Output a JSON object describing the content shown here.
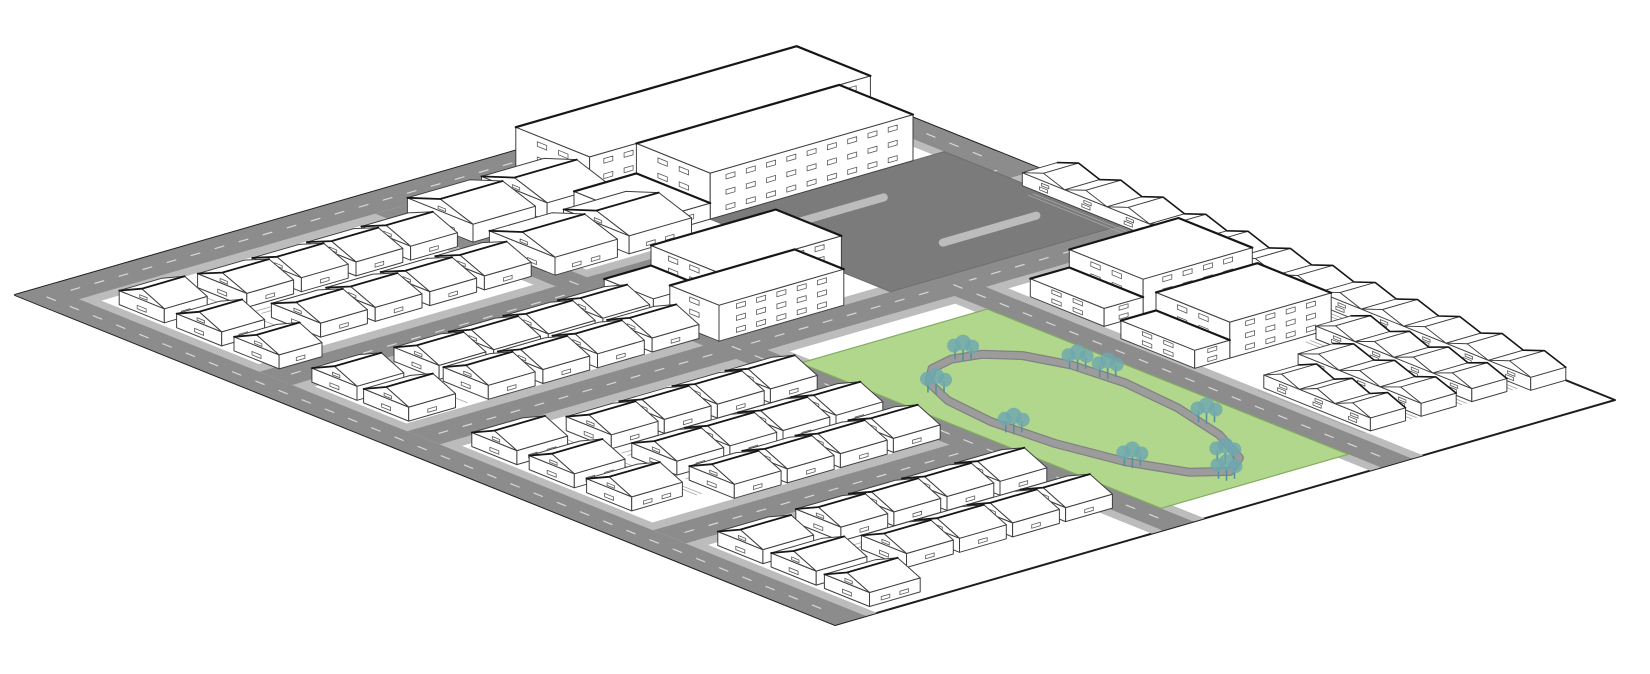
{
  "meta": {
    "alt_text": "Axonometric masterplan diagram of a neighbourhood block: white line-drawn houses, terraces and apartment slabs, a civic complex with a paved plaza, a street grid with sidewalks, and a green park with a loop path and trees."
  },
  "canvas": {
    "w": 1650,
    "h": 674,
    "bg": "#ffffff"
  },
  "projection": {
    "ox": 15,
    "oy": 295,
    "u": [
      8.2,
      3.3
    ],
    "v": [
      7.8,
      -2.25
    ]
  },
  "colors": {
    "outline": "#1d1d1d",
    "ground": "#ffffff",
    "road": "#8c8c8c",
    "roadCasing": "#bcbcbc",
    "roadDash": "#d8d8d8",
    "plaza": "#7b7b7b",
    "park": "#b0d78c",
    "parkEdge": "#84ac60",
    "path": "#9c9c9c",
    "pathEdge": "#828282",
    "tree": "#6fa7b0",
    "treeDark": "#55919c",
    "building": "#ffffff",
    "buildingLine": "#3f3f3f",
    "window": "#5a5a5a",
    "fence": "#a6a6a6",
    "shadow": "#161616"
  },
  "site": {
    "a": [
      0,
      100
    ],
    "b": [
      0,
      100
    ]
  },
  "roads": [
    {
      "name": "road-nw-boundary",
      "a": [
        0,
        4
      ],
      "b": [
        0,
        100
      ],
      "dash": {
        "axis": "b",
        "c": 2,
        "r": [
          2,
          98
        ]
      }
    },
    {
      "name": "road-sw-boundary",
      "a": [
        0,
        100
      ],
      "b": [
        0,
        4
      ],
      "dash": {
        "axis": "a",
        "c": 2,
        "r": [
          2,
          98
        ]
      }
    },
    {
      "name": "road-ne-boundary",
      "a": [
        0,
        30
      ],
      "b": [
        96,
        100
      ],
      "dash": {
        "axis": "a",
        "c": 98,
        "r": [
          1,
          29
        ]
      }
    },
    {
      "name": "street-west",
      "a": [
        26,
        30
      ],
      "b": [
        4,
        100
      ],
      "dash": {
        "axis": "b",
        "c": 28,
        "r": [
          6,
          98
        ]
      }
    },
    {
      "name": "street-central",
      "a": [
        44,
        48
      ],
      "b": [
        4,
        100
      ],
      "dash": {
        "axis": "b",
        "c": 46,
        "r": [
          6,
          98
        ]
      }
    },
    {
      "name": "street-south",
      "a": [
        74,
        78
      ],
      "b": [
        4,
        44
      ],
      "dash": {
        "axis": "b",
        "c": 76,
        "r": [
          6,
          42
        ]
      }
    },
    {
      "name": "avenue-lower",
      "a": [
        4,
        100
      ],
      "b": [
        42,
        46
      ],
      "dash": {
        "axis": "a",
        "c": 44,
        "r": [
          6,
          98
        ]
      }
    },
    {
      "name": "avenue-park",
      "a": [
        44,
        100
      ],
      "b": [
        70,
        74
      ],
      "dash": {
        "axis": "a",
        "c": 72,
        "r": [
          46,
          98
        ]
      }
    }
  ],
  "sidewalks": [
    {
      "a": [
        4,
        5.4
      ],
      "b": [
        0,
        100
      ]
    },
    {
      "a": [
        0,
        100
      ],
      "b": [
        4,
        5.4
      ]
    },
    {
      "a": [
        0,
        30
      ],
      "b": [
        94.6,
        96
      ]
    },
    {
      "a": [
        24.6,
        26
      ],
      "b": [
        4,
        100
      ]
    },
    {
      "a": [
        30,
        31.4
      ],
      "b": [
        4,
        100
      ]
    },
    {
      "a": [
        42.6,
        44
      ],
      "b": [
        4,
        100
      ]
    },
    {
      "a": [
        48,
        49.4
      ],
      "b": [
        4,
        100
      ]
    },
    {
      "a": [
        72.6,
        74
      ],
      "b": [
        4,
        44
      ]
    },
    {
      "a": [
        78,
        79.4
      ],
      "b": [
        4,
        44
      ]
    },
    {
      "a": [
        4,
        100
      ],
      "b": [
        40.6,
        42
      ]
    },
    {
      "a": [
        4,
        100
      ],
      "b": [
        46,
        47.4
      ]
    },
    {
      "a": [
        44,
        100
      ],
      "b": [
        68.6,
        70
      ]
    },
    {
      "a": [
        44,
        100
      ],
      "b": [
        74,
        75.4
      ]
    }
  ],
  "plaza": {
    "a": [
      22,
      44
    ],
    "b": [
      66,
      96
    ],
    "islands": [
      {
        "a": 27,
        "b": [
          71,
          83
        ]
      },
      {
        "a": 38,
        "b": [
          79,
          91
        ]
      }
    ]
  },
  "park": {
    "a": [
      52,
      96
    ],
    "b": [
      46,
      70
    ],
    "loop": [
      [
        93,
        58
      ],
      [
        91.1,
        61.2
      ],
      [
        86,
        64
      ],
      [
        79.1,
        65.9
      ],
      [
        72,
        66.6
      ],
      [
        66.1,
        65.9
      ],
      [
        62,
        64
      ],
      [
        59.7,
        61.2
      ],
      [
        59,
        58
      ],
      [
        59.7,
        54.8
      ],
      [
        62,
        52
      ],
      [
        66.1,
        50.1
      ],
      [
        72,
        49.4
      ],
      [
        79.1,
        50.1
      ],
      [
        86,
        52
      ],
      [
        91.1,
        54.8
      ]
    ],
    "trees": [
      [
        91,
        59.5
      ],
      [
        83,
        65.5
      ],
      [
        70,
        66.5
      ],
      [
        59.5,
        59
      ],
      [
        64,
        50.8
      ],
      [
        75,
        49.2
      ],
      [
        87,
        51.8
      ],
      [
        94,
        56.5
      ],
      [
        67,
        65.8
      ]
    ]
  },
  "fences": [
    {
      "a": [
        15.1,
        15.1
      ],
      "b": [
        15,
        41
      ]
    },
    {
      "a": [
        15.8,
        15.8
      ],
      "b": [
        15,
        41
      ]
    },
    {
      "a": [
        14.9,
        14.9
      ],
      "b": [
        44,
        62
      ]
    },
    {
      "a": [
        38.4,
        38.4
      ],
      "b": [
        16,
        40
      ]
    },
    {
      "a": [
        58.8,
        58.8
      ],
      "b": [
        16,
        42
      ]
    },
    {
      "a": [
        59.5,
        59.5
      ],
      "b": [
        16,
        42
      ]
    },
    {
      "a": [
        66.6,
        66.6
      ],
      "b": [
        16,
        42
      ]
    },
    {
      "a": [
        86.8,
        86.8
      ],
      "b": [
        16,
        42
      ]
    },
    {
      "a": [
        87.5,
        87.5
      ],
      "b": [
        16,
        42
      ]
    },
    {
      "a": [
        50,
        70
      ],
      "b": [
        13.8,
        13.8
      ]
    },
    {
      "a": [
        50,
        70
      ],
      "b": [
        14.4,
        14.4
      ]
    },
    {
      "a": [
        80,
        96
      ],
      "b": [
        13.8,
        13.8
      ]
    },
    {
      "a": [
        6,
        23
      ],
      "b": [
        13.8,
        13.8
      ]
    },
    {
      "a": [
        30,
        42
      ],
      "b": [
        13.8,
        13.8
      ]
    },
    {
      "a": [
        34,
        93
      ],
      "b": [
        94.2,
        94.2
      ]
    },
    {
      "a": [
        34,
        93
      ],
      "b": [
        94.8,
        94.8
      ]
    },
    {
      "a": [
        74,
        93
      ],
      "b": [
        87.7,
        87.7
      ]
    },
    {
      "a": [
        74,
        93
      ],
      "b": [
        88.3,
        88.3
      ]
    },
    {
      "a": [
        78,
        93
      ],
      "b": [
        81.3,
        81.3
      ]
    },
    {
      "a": [
        78,
        93
      ],
      "b": [
        81.9,
        81.9
      ]
    },
    {
      "a": [
        80,
        93
      ],
      "b": [
        75.2,
        75.2
      ]
    }
  ],
  "buildings": [
    {
      "name": "civic-block-rear",
      "type": "slab",
      "a": 4,
      "b": 60,
      "da": 9,
      "db": 36,
      "h": 46,
      "floors": 3
    },
    {
      "name": "civic-block-front",
      "type": "slab",
      "a": 13,
      "b": 66,
      "da": 9,
      "db": 26,
      "h": 46,
      "floors": 3
    },
    {
      "name": "civic-block-wing",
      "type": "slab",
      "a": 13,
      "b": 58,
      "da": 9,
      "db": 8,
      "h": 16,
      "floors": 1
    },
    {
      "name": "apartment-ne-1-low",
      "type": "slab",
      "a": 52,
      "b": 75.5,
      "da": 9,
      "db": 5,
      "h": 18,
      "floors": 2
    },
    {
      "name": "apartment-ne-1",
      "type": "slab",
      "a": 52,
      "b": 80.5,
      "da": 9,
      "db": 14,
      "h": 36,
      "floors": 3
    },
    {
      "name": "apartment-ne-2-low",
      "type": "slab",
      "a": 64,
      "b": 74.5,
      "da": 9,
      "db": 4.5,
      "h": 18,
      "floors": 2
    },
    {
      "name": "apartment-ne-2",
      "type": "slab",
      "a": 64,
      "b": 79,
      "da": 9,
      "db": 13,
      "h": 36,
      "floors": 3
    },
    {
      "name": "apartment-mid-low",
      "type": "slab",
      "a": 30,
      "b": 44,
      "da": 6,
      "db": 6,
      "h": 16,
      "floors": 1
    },
    {
      "name": "apartment-mid-1",
      "type": "slab",
      "a": 30,
      "b": 50,
      "da": 8,
      "db": 16,
      "h": 36,
      "floors": 3
    },
    {
      "name": "apartment-mid-2",
      "type": "slab",
      "a": 38,
      "b": 44,
      "da": 6,
      "db": 16,
      "h": 36,
      "floors": 3
    },
    {
      "name": "house-row-west-front",
      "type": "gableRow",
      "axis": "a",
      "b": 6,
      "a0": 7,
      "n": 3,
      "step": 7,
      "da": 5.5,
      "db": 5.5,
      "he": 14,
      "hr": 25
    },
    {
      "name": "house-row-west-1",
      "type": "gableRow",
      "axis": "b",
      "a": 8,
      "b0": 15,
      "n": 4,
      "step": 7,
      "da": 6,
      "db": 6,
      "he": 14,
      "hr": 25
    },
    {
      "name": "house-row-west-2",
      "type": "gableRow",
      "axis": "b",
      "a": 17,
      "b0": 15,
      "n": 4,
      "step": 7,
      "da": 6,
      "db": 6,
      "he": 14,
      "hr": 25
    },
    {
      "name": "semi-row-nw-1",
      "type": "gableRow",
      "axis": "b",
      "a": 6,
      "b0": 44,
      "n": 2,
      "step": 9.5,
      "da": 8,
      "db": 8,
      "he": 18,
      "hr": 30
    },
    {
      "name": "semi-row-nw-2",
      "type": "gableRow",
      "axis": "b",
      "a": 16,
      "b0": 44,
      "n": 2,
      "step": 9.5,
      "da": 8,
      "db": 8,
      "he": 18,
      "hr": 30
    },
    {
      "name": "house-row-sw-front",
      "type": "gableRow",
      "axis": "a",
      "b": 6,
      "a0": 30.5,
      "n": 2,
      "step": 6.3,
      "da": 5.5,
      "db": 6,
      "he": 14,
      "hr": 25
    },
    {
      "name": "house-row-sw-1",
      "type": "gableRow",
      "axis": "b",
      "a": 31,
      "b0": 16,
      "n": 4,
      "step": 7,
      "da": 5.5,
      "db": 6,
      "he": 14,
      "hr": 25
    },
    {
      "name": "house-row-sw-2",
      "type": "gableRow",
      "axis": "b",
      "a": 37,
      "b0": 16,
      "n": 4,
      "step": 7,
      "da": 5.5,
      "db": 6,
      "he": 14,
      "hr": 25
    },
    {
      "name": "house-row-s-front-1",
      "type": "gableRow",
      "axis": "a",
      "b": 6,
      "a0": 50,
      "n": 3,
      "step": 7,
      "da": 5.5,
      "db": 6.5,
      "he": 14,
      "hr": 25
    },
    {
      "name": "house-row-s-front-2",
      "type": "gableRow",
      "axis": "a",
      "b": 6,
      "a0": 80,
      "n": 3,
      "step": 6.5,
      "da": 5.5,
      "db": 6.5,
      "he": 14,
      "hr": 25
    },
    {
      "name": "terrace-row-s-1",
      "type": "gableRow",
      "axis": "b",
      "a": 52,
      "b0": 16,
      "n": 4,
      "step": 6.8,
      "da": 5.5,
      "db": 6,
      "he": 14,
      "hr": 25
    },
    {
      "name": "terrace-row-s-2",
      "type": "gableRow",
      "axis": "b",
      "a": 60,
      "b0": 16,
      "n": 4,
      "step": 6.8,
      "da": 5.5,
      "db": 6,
      "he": 14,
      "hr": 25
    },
    {
      "name": "terrace-row-s-3",
      "type": "gableRow",
      "axis": "b",
      "a": 67,
      "b0": 16,
      "n": 4,
      "step": 6.8,
      "da": 5.5,
      "db": 6,
      "he": 14,
      "hr": 25
    },
    {
      "name": "terrace-row-s-4",
      "type": "gableRow",
      "axis": "b",
      "a": 80,
      "b0": 16,
      "n": 4,
      "step": 6.8,
      "da": 5.5,
      "db": 6,
      "he": 14,
      "hr": 25
    },
    {
      "name": "terrace-row-s-5",
      "type": "gableRow",
      "axis": "b",
      "a": 88,
      "b0": 16,
      "n": 4,
      "step": 6.8,
      "da": 5.5,
      "db": 6,
      "he": 14,
      "hr": 25
    },
    {
      "name": "terrace-row-e-1",
      "type": "terrace",
      "a": 32,
      "b": 95.5,
      "len": 62,
      "db": 4.5,
      "he": 13,
      "bump": 8,
      "unit": 5.2
    },
    {
      "name": "terrace-row-e-2",
      "type": "terrace",
      "a": 74,
      "b": 89,
      "len": 19,
      "db": 4.5,
      "he": 13,
      "bump": 8,
      "unit": 5.0
    },
    {
      "name": "terrace-row-e-3",
      "type": "terrace",
      "a": 78,
      "b": 82.5,
      "len": 15,
      "db": 4.5,
      "he": 13,
      "bump": 8,
      "unit": 5.0
    },
    {
      "name": "terrace-row-e-4",
      "type": "terrace",
      "a": 80,
      "b": 76,
      "len": 13,
      "db": 4.5,
      "he": 13,
      "bump": 8,
      "unit": 4.4
    }
  ]
}
